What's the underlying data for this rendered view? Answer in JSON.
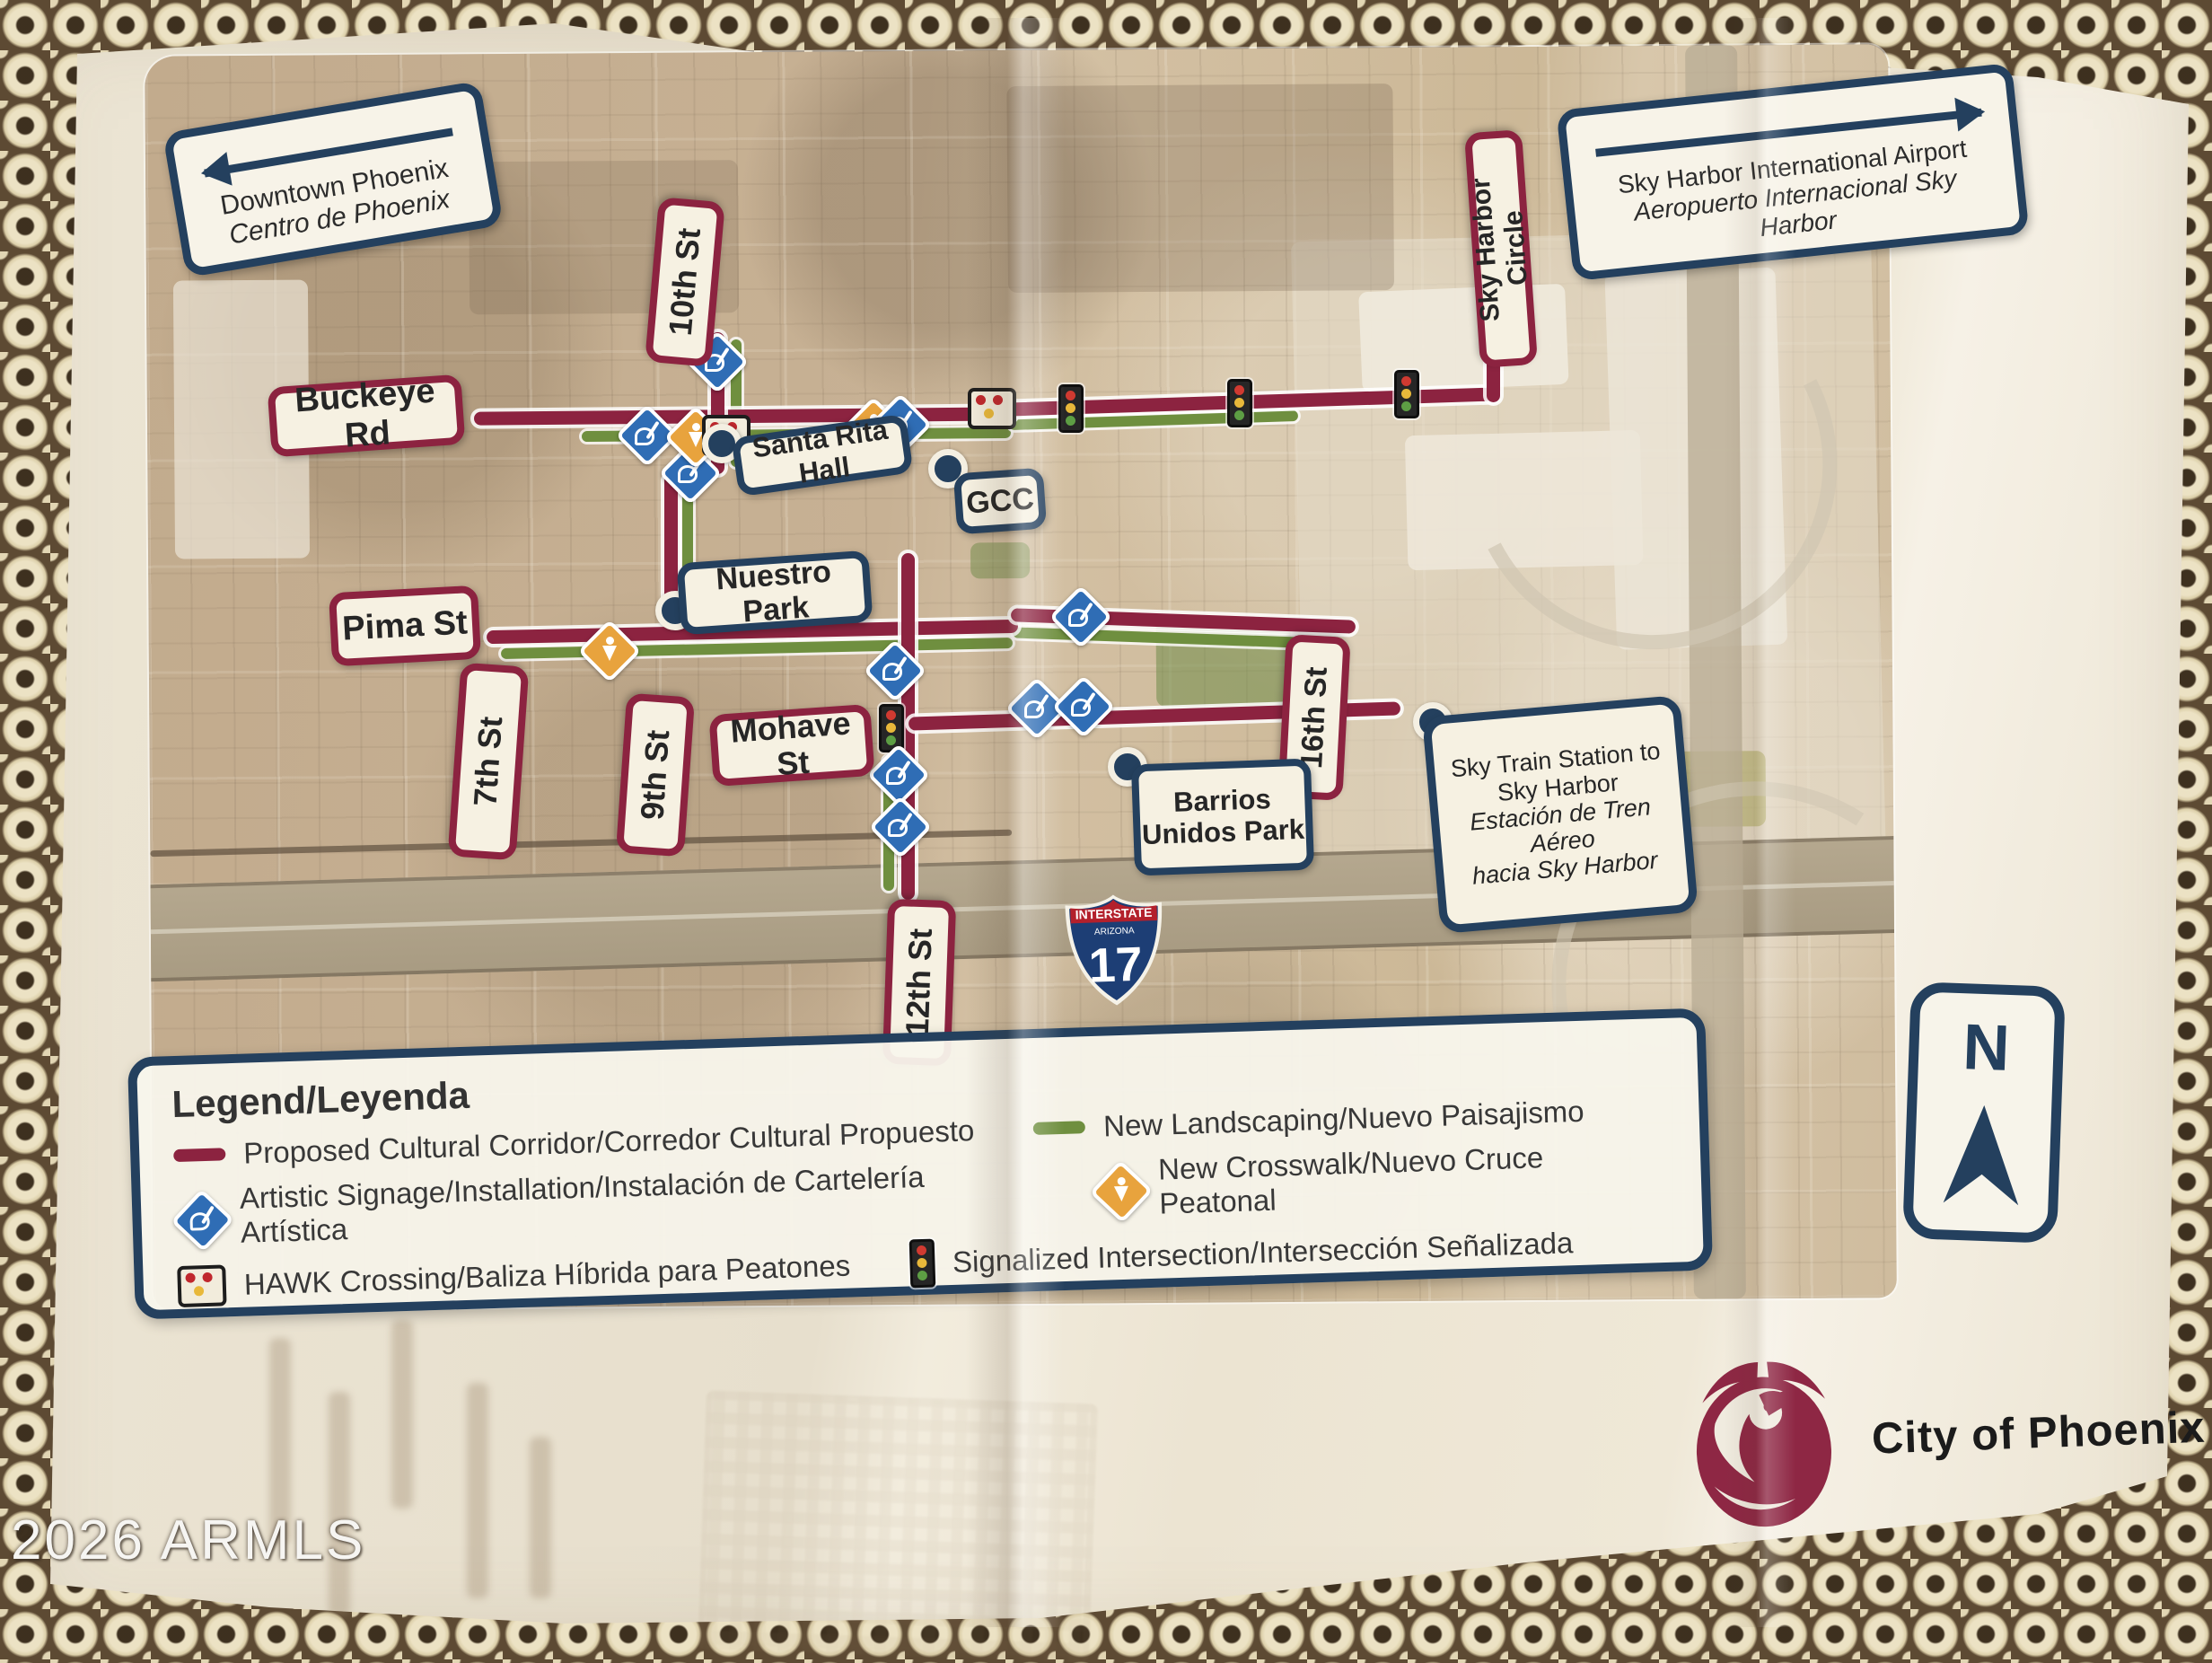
{
  "photo": {
    "watermark": "2026 ARMLS"
  },
  "map": {
    "direction_boxes": {
      "downtown": {
        "line1": "Downtown Phoenix",
        "line2": "Centro de Phoenix"
      },
      "airport": {
        "line1": "Sky Harbor International Airport",
        "line2": "Aeropuerto Internacional Sky",
        "line3": "Harbor"
      }
    },
    "street_labels": {
      "buckeye": "Buckeye Rd",
      "pima": "Pima St",
      "mohave": "Mohave St",
      "seventh": "7th St",
      "ninth": "9th St",
      "tenth": "10th St",
      "twelfth": "12th St",
      "sixteenth": "16th St",
      "sky_harbor_circle": "Sky Harbor Circle"
    },
    "place_labels": {
      "santa_rita": "Santa Rita Hall",
      "gcc": "GCC",
      "nuestro": "Nuestro Park",
      "barrios_line1": "Barrios",
      "barrios_line2": "Unidos Park",
      "sky_train_line1": "Sky Train Station to",
      "sky_train_line2": "Sky Harbor",
      "sky_train_line3": "Estación de Tren Aéreo",
      "sky_train_line4": "hacia Sky Harbor"
    },
    "interstate_shield": {
      "banner": "INTERSTATE",
      "state": "ARIZONA",
      "number": "17"
    },
    "compass": {
      "letter": "N"
    }
  },
  "legend": {
    "title": "Legend/Leyenda",
    "items": [
      {
        "icon": "corridor-line",
        "label": "Proposed Cultural Corridor/Corredor Cultural Propuesto"
      },
      {
        "icon": "landscaping-line",
        "label": "New Landscaping/Nuevo Paisajismo"
      },
      {
        "icon": "artistic-signage-diamond",
        "label": "Artistic Signage/Installation/Instalación de Cartelería Artística"
      },
      {
        "icon": "crosswalk-diamond",
        "label": "New Crosswalk/Nuevo Cruce Peatonal"
      },
      {
        "icon": "hawk-beacon",
        "label": "HAWK Crossing/Baliza Híbrida para Peatones"
      },
      {
        "icon": "traffic-signal",
        "label": "Signalized Intersection/Intersección Señalizada"
      }
    ]
  },
  "footer": {
    "logo_text": "City of Phoenix"
  },
  "colors": {
    "corridor_maroon": "#8c2340",
    "landscaping_green": "#6f8f3f",
    "label_navy": "#24405e",
    "signage_blue": "#2f6db5",
    "crosswalk_yellow": "#e8a33d",
    "logo_maroon": "#8e2744"
  }
}
